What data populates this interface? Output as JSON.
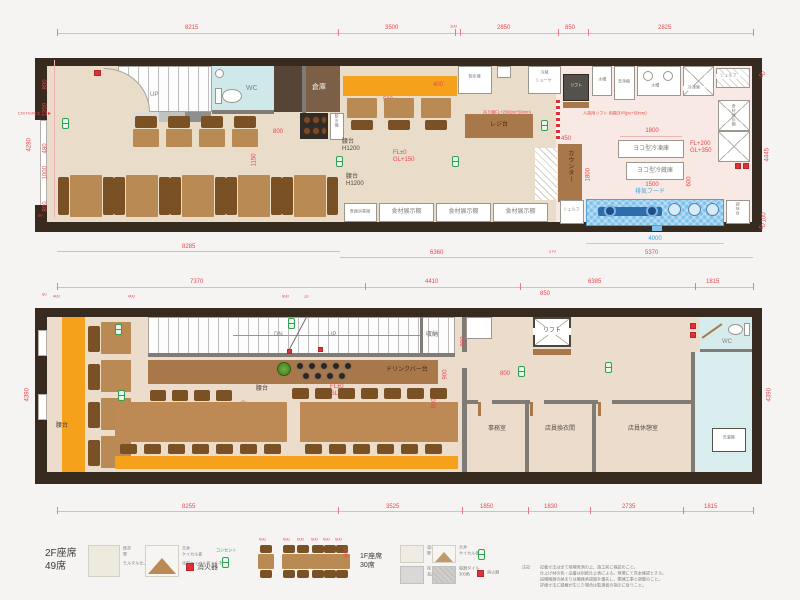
{
  "f1": {
    "top_dims": [
      "8215",
      "3500",
      "100",
      "2850",
      "850",
      "2825"
    ],
    "bottom_dims": [
      "8285",
      "6360",
      "270",
      "5370"
    ],
    "hood_dim_blue": "4000",
    "left_dims": [
      "800",
      "1200",
      "480",
      "1000",
      "800",
      "50"
    ],
    "left_total": "4280",
    "right_dims": [
      "50",
      "4445",
      "100",
      "50"
    ],
    "entrance": "ENTRANCE",
    "entrance_arrow": "▶",
    "up": "UP",
    "wc": "WC",
    "storage": "倉庫",
    "water_server": "飲水機",
    "ice_maker": "製氷機",
    "showcase1": "冷蔵",
    "showcase2": "ショーケ",
    "lift": "リフト",
    "sink1": "水槽",
    "dishwasher": "洗浄機",
    "sink2": "水槽",
    "freezer": "冷凍庫",
    "shelf_top": "シェルフ",
    "food_storage_shelf": "食材保存棚",
    "yoko_freezer": "ヨコ型冷凍庫",
    "yoko_fridge": "ヨコ型冷蔵庫",
    "fl_plus": "FL+200",
    "gl_plus": "GL+350",
    "hood_label": "排気フード",
    "shelf_bottom": "シェルフ",
    "seasoning": "調味台",
    "counter_v": "カウンター",
    "register": "レジ台",
    "koshidai": "腰台",
    "h1200": "H1200",
    "fl0": "FL±0",
    "gl150": "GL+150",
    "dish_shelf": "食器消毒棚",
    "food_shelf": "食材展示棚",
    "note_shelf": "吊り棚FL+250(pic+50mm)",
    "note_lift": "人荷用リフト 両開き戸(pic+50mm)",
    "dim_500": "500",
    "dim_400": "400",
    "dim_800": "800",
    "dim_1150": "1150",
    "dim_450": "450",
    "dim_1800_h": "1800",
    "dim_1800_v": "1800",
    "dim_600": "600",
    "dim_1500": "1500"
  },
  "f2": {
    "top_dims": [
      "7370",
      "4410",
      "6385",
      "1815"
    ],
    "sub_dims": [
      "50",
      "400",
      "400",
      "900",
      "10",
      "850"
    ],
    "bottom_dims": [
      "8255",
      "3525",
      "1850",
      "1830",
      "2735",
      "1815"
    ],
    "left_total": "4390",
    "right_total": "4390",
    "dn": "DN",
    "up": "UP",
    "shuno": "収納",
    "drink_bar": "ドリンクバー台",
    "koshidai_a": "腰台",
    "koshidai_b": "腰台",
    "fl0": "FL±0",
    "gl150": "GL+150",
    "lift": "リフト",
    "wc": "WC",
    "office": "事務室",
    "changing": "店員換衣間",
    "rest": "店員休憩室",
    "washer": "洗濯機",
    "dim_400v": "400",
    "dim_800a": "800",
    "dim_900": "900",
    "dim_800b": "800",
    "dim_800c": "800"
  },
  "legend": {
    "f2_seats_line1": "2F座席",
    "f2_seats_line2": "49席",
    "sw1_l1": "既存",
    "sw1_l2": "壁",
    "sw1_sub": "モルタル仕上(現状)",
    "sw2_l1": "天井",
    "sw2_l2": "ケイカル板",
    "sw2_sub": "化粧ケイカル板 t=6 不燃",
    "fire": "消火器",
    "outlet": "コンセント",
    "dim600": "600",
    "f1_seats_line1": "1F座席",
    "f1_seats_line2": "30席",
    "r1c1_l1": "塗装",
    "r1c1_l2": "壁",
    "r1c2_l1": "天井",
    "r1c2_l2": "ケイカル板",
    "r2c1_l1": "床",
    "r2c1_l2": "長尺シート",
    "r2c2_l1": "磁器タイル",
    "r2c2_l2": "300角",
    "fire2": "消火器",
    "notes_title": "注記",
    "notes": [
      "記載寸法は全て現場実測の上、施工前に確認のこと。",
      "仕上げ材の色・品番は別紙仕上表による。現場にて見本確認とする。",
      "設備機器の納まりは機器承認図を優先し、関連工事と調整のこと。",
      "詳細寸法に疑義が生じた場合は監理者の指示に従うこと。"
    ]
  }
}
